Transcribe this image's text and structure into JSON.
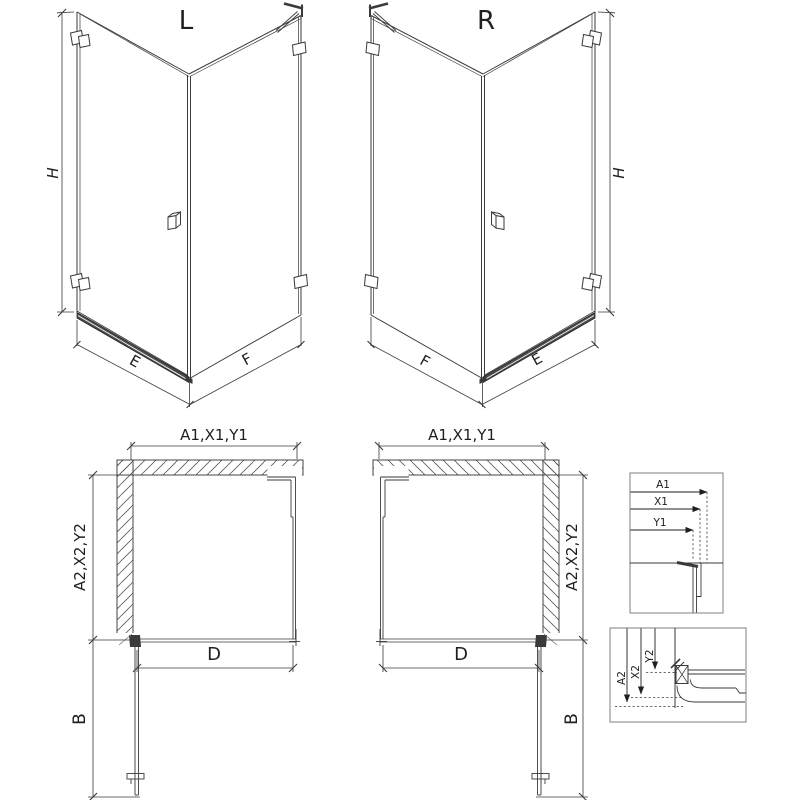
{
  "drawing": {
    "iso_left": {
      "label": "L",
      "height_dim": "H",
      "door_width_dim": "E",
      "panel_width_dim": "F"
    },
    "iso_right": {
      "label": "R",
      "height_dim": "H",
      "door_width_dim": "E",
      "panel_width_dim": "F"
    },
    "plan_left": {
      "width_dim": "A1,X1,Y1",
      "depth_dim": "A2,X2,Y2",
      "opening_dim": "D",
      "door_dim": "B"
    },
    "plan_right": {
      "width_dim": "A1,X1,Y1",
      "depth_dim": "A2,X2,Y2",
      "opening_dim": "D",
      "door_dim": "B"
    },
    "detail_wall_profile": {
      "dim1": "A1",
      "dim2": "X1",
      "dim3": "Y1"
    },
    "detail_tray_profile": {
      "dim1": "A2",
      "dim2": "X2",
      "dim3": "Y2"
    },
    "colors": {
      "line": "#3a3a3a",
      "dark": "#1f1f1f",
      "hatch": "#5a5a5a",
      "frame": "#8a8a8a",
      "background": "#ffffff"
    }
  }
}
